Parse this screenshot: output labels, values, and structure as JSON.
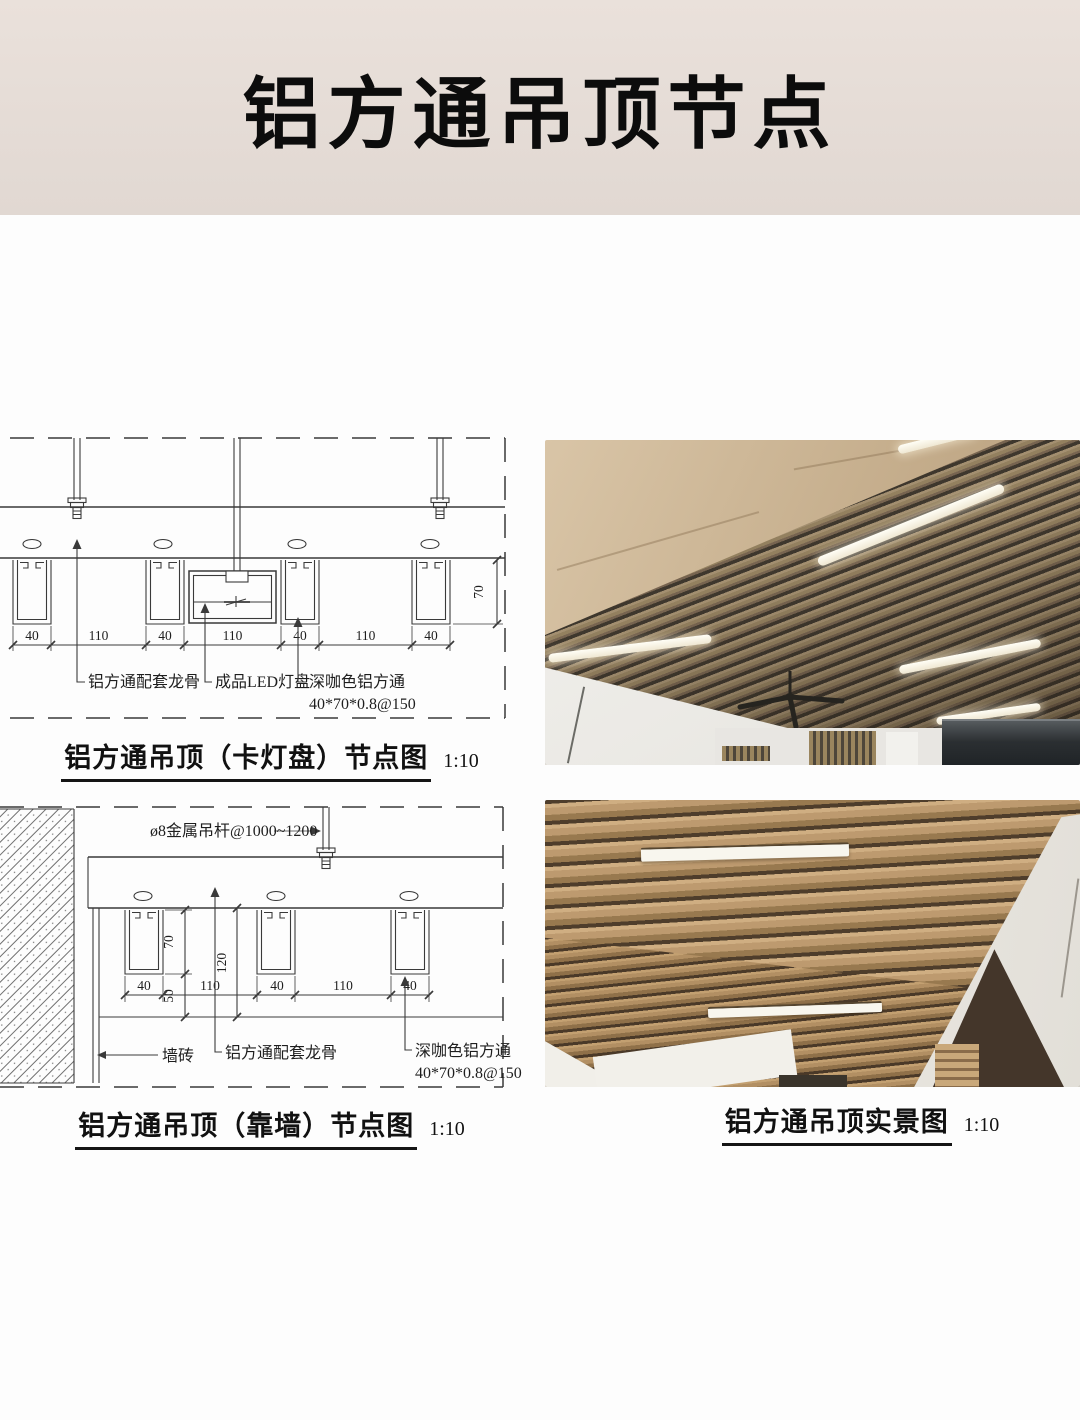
{
  "banner": {
    "title": "铝方通吊顶节点"
  },
  "drawing1": {
    "caption": "铝方通吊顶（卡灯盘）节点图",
    "scale": "1:10",
    "dims_h": [
      "40",
      "110",
      "40",
      "110",
      "40",
      "110",
      "40"
    ],
    "dim_height": "70",
    "labels": {
      "keel": "铝方通配套龙骨",
      "led": "成品LED灯盘",
      "tube": "深咖色铝方通",
      "tube_spec": "40*70*0.8@150"
    }
  },
  "drawing2": {
    "caption": "铝方通吊顶（靠墙）节点图",
    "scale": "1:10",
    "hanger": "ø8金属吊杆@1000~1200",
    "dims_h": [
      "40",
      "110",
      "40",
      "110",
      "40"
    ],
    "dim_70": "70",
    "dim_120": "120",
    "dim_50": "50",
    "labels": {
      "wall_tile": "墙砖",
      "keel": "铝方通配套龙骨",
      "tube": "深咖色铝方通",
      "tube_spec": "40*70*0.8@150"
    }
  },
  "photo_section": {
    "caption": "铝方通吊顶实景图",
    "scale": "1:10"
  },
  "colors": {
    "banner_bg": "#e5dcd6",
    "drawing_line": "#3a3a3a",
    "slat_dark_brown": "#8f7254",
    "slat_wood_brown": "#a9865c",
    "ceiling_beige": "#c3ab8a"
  }
}
